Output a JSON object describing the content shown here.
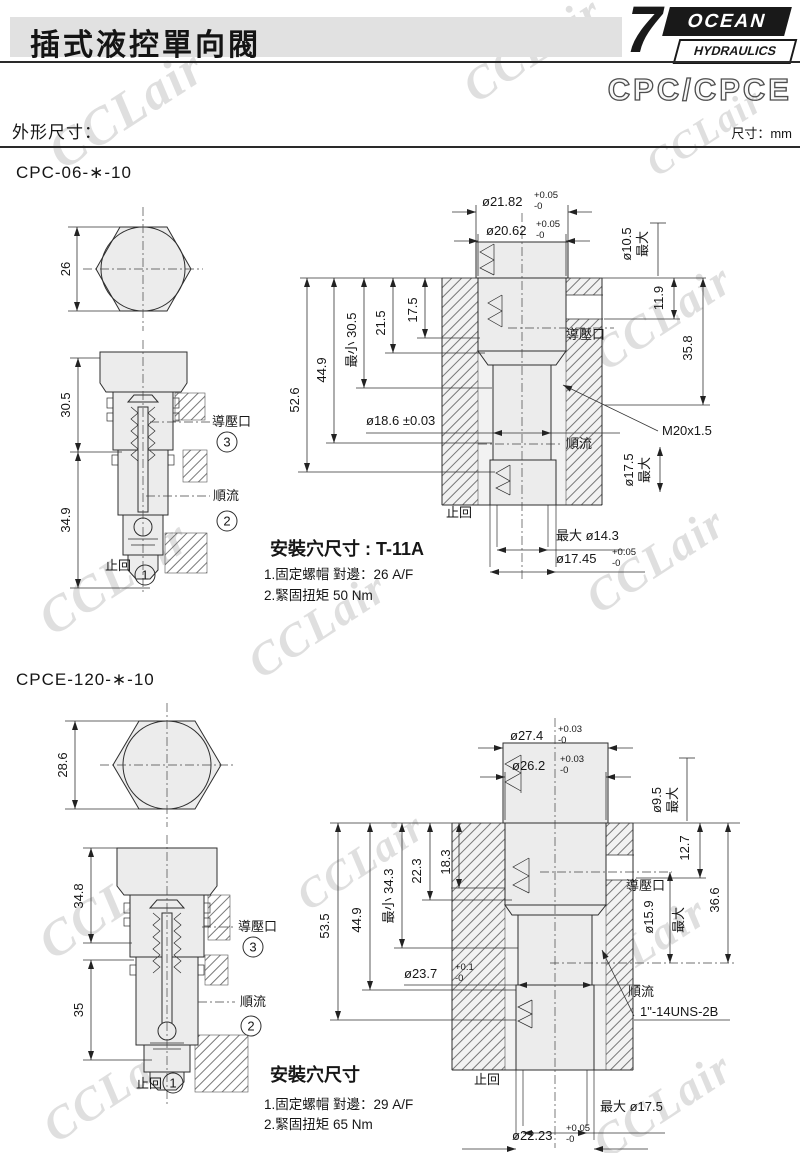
{
  "header": {
    "title": "插式液控單向閥",
    "series": "CPC/CPCE",
    "section": "外形尺寸：",
    "unit": "尺寸：mm",
    "brand": {
      "seven": "7",
      "name": "OCEAN",
      "sub": "HYDRAULICS"
    }
  },
  "colors": {
    "ink": "#2a2a2a",
    "drawing_fill": "#ececec",
    "header_bar": "#e1e1e1"
  },
  "watermark": "CCLair",
  "ports": {
    "pilot": "導壓口",
    "flow": "順流",
    "check": "止回",
    "n1": "1",
    "n2": "2",
    "n3": "3"
  },
  "fig1": {
    "model": "CPC-06-∗-10",
    "hex_af": "26",
    "len_top": "30.5",
    "len_bottom": "34.9",
    "cavity": {
      "bore1": "ø21.82",
      "bore1_tp": "+0.05",
      "bore1_tm": "-0",
      "bore2": "ø20.62",
      "bore2_tp": "+0.05",
      "bore2_tm": "-0",
      "pilot_bore": "ø10.5",
      "pilot_bore_max": "最大",
      "pilot_depth": "11.9",
      "thread_depth": "35.8",
      "pilot": "導壓口",
      "total_depth": "52.6",
      "depth2": "44.9",
      "depth3": "最小 30.5",
      "depth4": "21.5",
      "depth5": "17.5",
      "seat_bore": "ø18.6 ±0.03",
      "thread": "M20x1.5",
      "flow": "順流",
      "out_bore": "ø17.5",
      "out_bore_max": "最大",
      "check": "止回",
      "bottom_bore1": "最大 ø14.3",
      "bottom_bore2": "ø17.45",
      "bottom_bore2_tp": "+0.05",
      "bottom_bore2_tm": "-0"
    },
    "cavity_title": "安裝穴尺寸 : T-11A",
    "note1": "1.固定螺帽 對邊：26 A/F",
    "note2": "2.緊固扭矩 50 Nm"
  },
  "fig2": {
    "model": "CPCE-120-∗-10",
    "hex_af": "28.6",
    "len_top": "34.8",
    "len_bottom": "35",
    "cavity": {
      "bore1": "ø27.4",
      "bore1_tp": "+0.03",
      "bore1_tm": "-0",
      "bore2": "ø26.2",
      "bore2_tp": "+0.03",
      "bore2_tm": "-0",
      "pilot_bore": "ø9.5",
      "pilot_bore_max": "最大",
      "pilot_depth": "12.7",
      "thread_depth": "36.6",
      "pilot": "導壓口",
      "total_depth": "53.5",
      "depth2": "44.9",
      "depth3": "最小 34.3",
      "depth4": "22.3",
      "depth5": "18.3",
      "seat_bore": "ø23.7",
      "seat_bore_tp": "+0.1",
      "seat_bore_tm": "-0",
      "mid_bore": "ø15.9",
      "mid_bore_max": "最大",
      "thread": "1\"-14UNS-2B",
      "flow": "順流",
      "check": "止回",
      "bottom_bore1": "最大 ø17.5",
      "bottom_bore2": "ø22.23",
      "bottom_bore2_tp": "+0.05",
      "bottom_bore2_tm": "-0"
    },
    "cavity_title": "安裝穴尺寸",
    "note1": "1.固定螺帽 對邊：29 A/F",
    "note2": "2.緊固扭矩 65 Nm"
  }
}
